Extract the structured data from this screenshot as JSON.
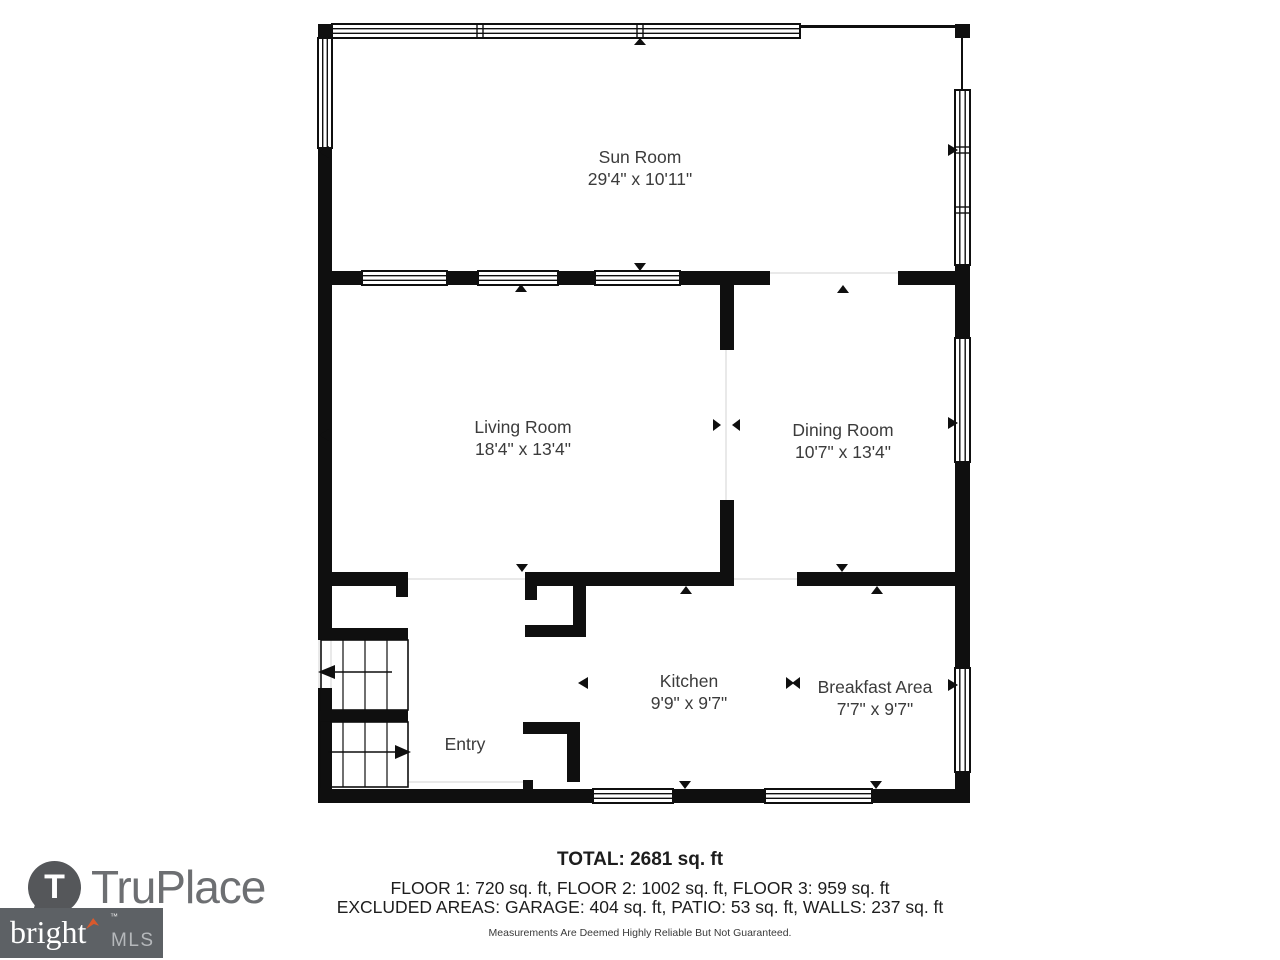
{
  "rooms": [
    {
      "name": "Sun Room",
      "dims": "29'4\" x 10'11\""
    },
    {
      "name": "Living Room",
      "dims": "18'4\" x 13'4\""
    },
    {
      "name": "Dining Room",
      "dims": "10'7\" x 13'4\""
    },
    {
      "name": "Kitchen",
      "dims": "9'9\" x 9'7\""
    },
    {
      "name": "Breakfast Area",
      "dims": "7'7\" x 9'7\""
    },
    {
      "name": "Entry",
      "dims": ""
    }
  ],
  "summary": {
    "total": "TOTAL: 2681 sq. ft",
    "floors": "FLOOR 1: 720 sq. ft, FLOOR 2: 1002 sq. ft, FLOOR 3: 959 sq. ft",
    "excluded": "EXCLUDED AREAS: GARAGE: 404 sq. ft, PATIO: 53 sq. ft, WALLS: 237 sq. ft",
    "disclaimer": "Measurements Are Deemed Highly Reliable But Not Guaranteed."
  },
  "branding": {
    "truplace_icon_letter": "T",
    "truplace_name": "TruPlace",
    "bright_name": "bright",
    "bright_tm": "™",
    "bright_suffix": "MLS"
  },
  "colors": {
    "wall": "#0f0f0f",
    "label_text": "#3b3b3b",
    "truplace_gray": "#6d6f72",
    "truplace_pin": "#55575a",
    "bright_box": "#5d6165",
    "bright_accent": "#d9592c",
    "bright_mls_text": "#b5b8bb"
  }
}
